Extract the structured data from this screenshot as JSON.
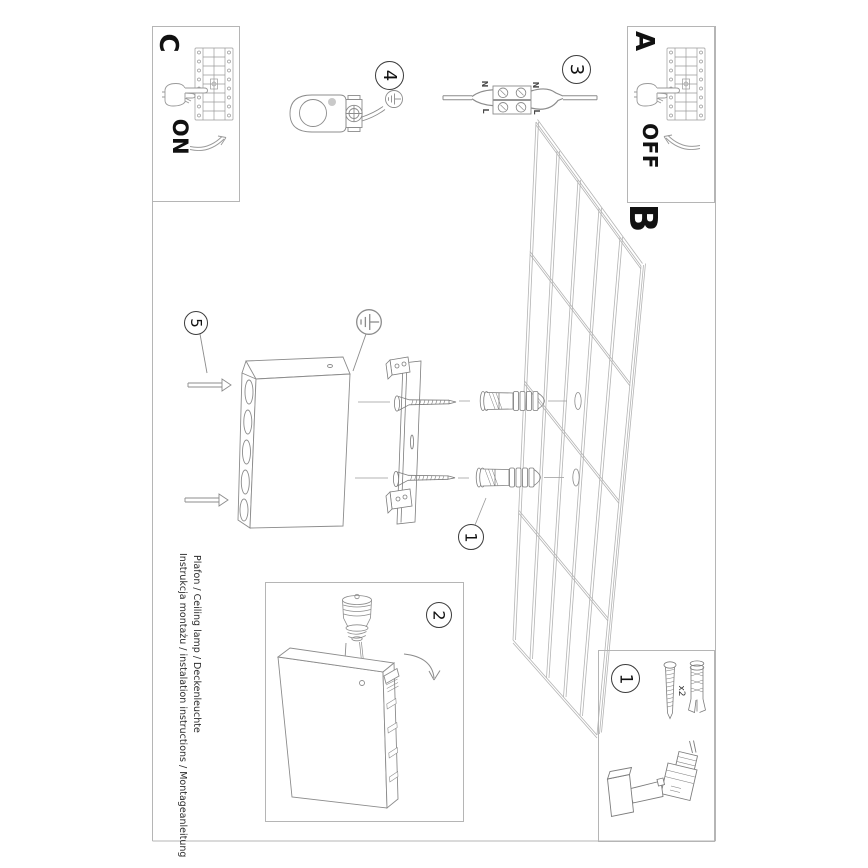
{
  "document": {
    "captions": {
      "title_line": "Instrukcja montażu / instalation instructions / Montageanleitung",
      "product_line": "Plafon / Ceiling lamp / Deckenleuchte"
    },
    "sections": {
      "c": {
        "label": "C",
        "switch_state": "ON"
      },
      "a": {
        "label": "A",
        "switch_state": "OFF"
      },
      "b": {
        "label": "B"
      }
    },
    "steps": {
      "s1": "1",
      "s2": "2",
      "s3": "3",
      "s4": "4",
      "s5": "5"
    },
    "wiring_labels": {
      "neutral": "N",
      "live": "L"
    },
    "parts": {
      "screw_plug_qty": "x2"
    }
  }
}
